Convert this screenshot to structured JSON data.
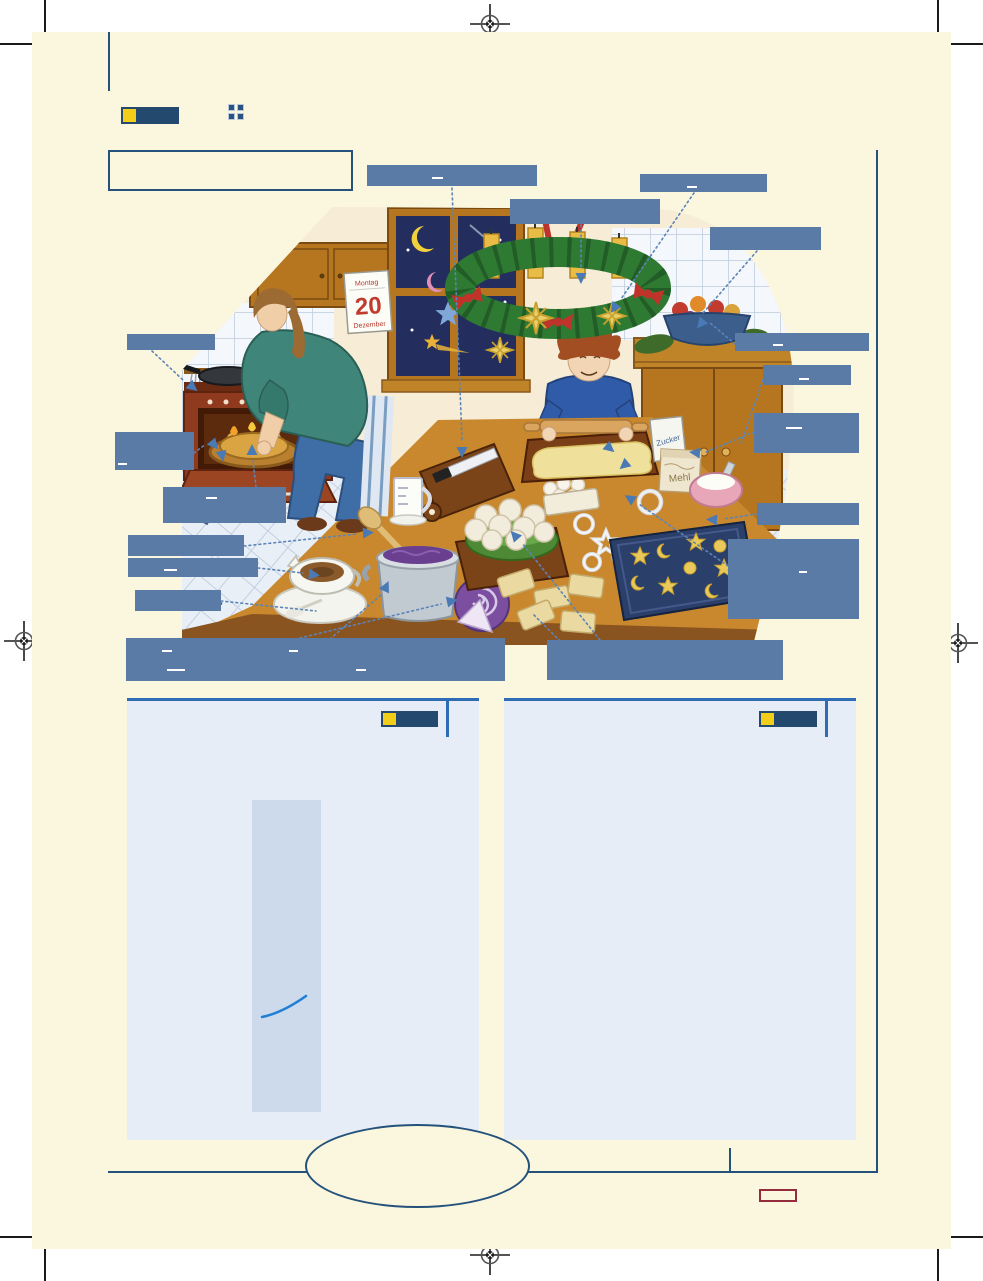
{
  "page": {
    "paper_color": "#fbf7de",
    "outside_color": "#ffffff",
    "frame_navy": "#24527c",
    "accent_blue": "#2e6cb5",
    "answer_box_blue": "#5a7ba6",
    "badge_navy": "#24496e",
    "badge_yellow": "#f2ce1b",
    "panel_bg": "#e7edf7",
    "panel_strip": "#cddaec",
    "stamp_red": "#942c3c"
  },
  "header": {
    "badge_label": "",
    "grid_icon": "four-squares"
  },
  "title_box": {
    "text": ""
  },
  "answer_boxes": {
    "count": 17
  },
  "illustration": {
    "scene": "christmas-baking-kitchen",
    "calendar": {
      "weekday": "Montag",
      "day": "20",
      "month": "Dezember"
    },
    "sugar_bag_label": "Zucker",
    "flour_bag_label": "Mehl"
  },
  "footer": {
    "page_number_box": ""
  }
}
